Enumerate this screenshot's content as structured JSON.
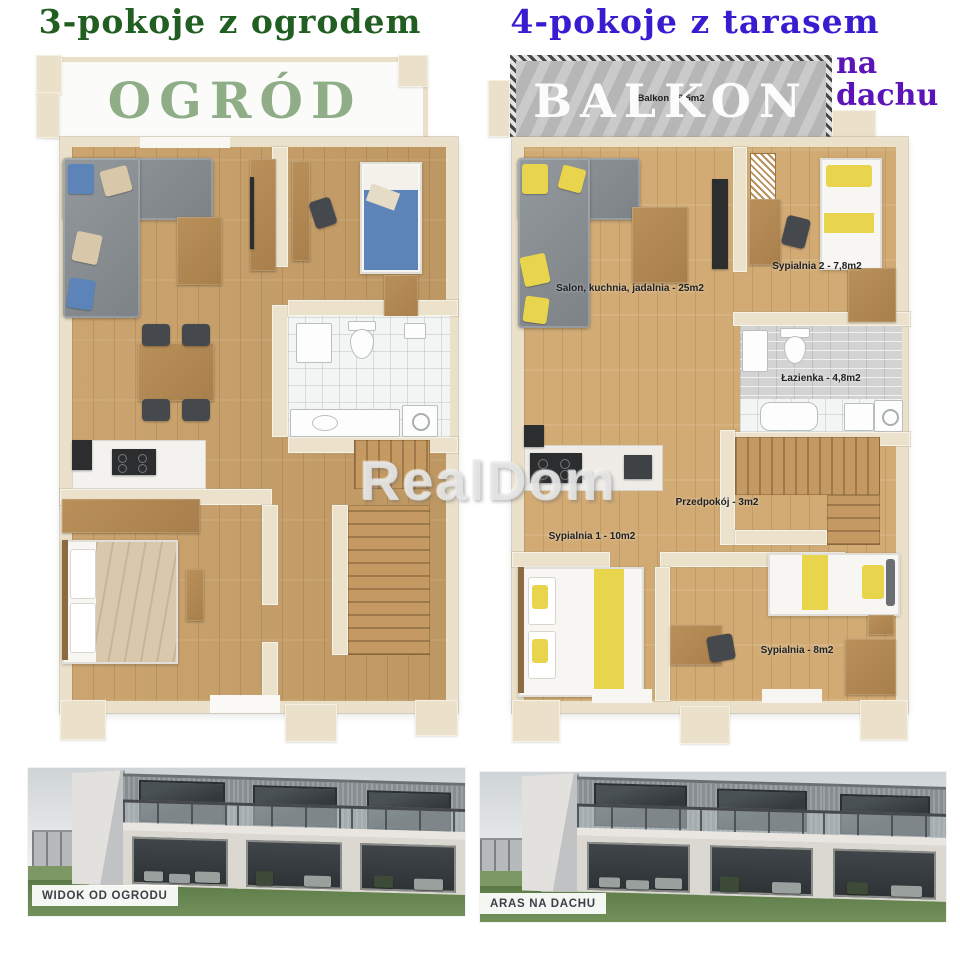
{
  "watermark": {
    "text": "RealDom"
  },
  "left_unit": {
    "title": "3-pokoje z ogrodem",
    "title_color": "#215e21",
    "garden_label": "OGRÓD",
    "garden_label_color": "#8fae88",
    "photo_badge": "WIDOK OD OGRODU"
  },
  "right_unit": {
    "title": "4-pokoje z tarasem",
    "title_suffix": "na dachu",
    "title_color": "#3a1bd0",
    "title_suffix_color": "#5a14b8",
    "balcony_label": "BALKON",
    "balcony_area_label": "Balkon - 8,5m2",
    "rooms": {
      "salon": "Salon, kuchnia, jadalnia - 25m2",
      "sypialnia2": "Sypialnia 2 - 7,8m2",
      "lazienka": "Łazienka - 4,8m2",
      "przedpokoj": "Przedpokój - 3m2",
      "sypialnia1": "Sypialnia 1 - 10m2",
      "sypialnia3": "Sypialnia - 8m2"
    },
    "photo_badge": "ARAS NA DACHU"
  },
  "colors": {
    "accent_green_dark": "#215e21",
    "accent_green_sage": "#8fae88",
    "accent_blue_violet": "#3a1bd0",
    "accent_purple": "#5a14b8",
    "wall_cream": "#ebe1ca",
    "wood_floor_left": "#c89f67",
    "wood_floor_right": "#d2ab74",
    "pillow_blue": "#5d84b8",
    "pillow_yellow": "#e8d44d"
  }
}
